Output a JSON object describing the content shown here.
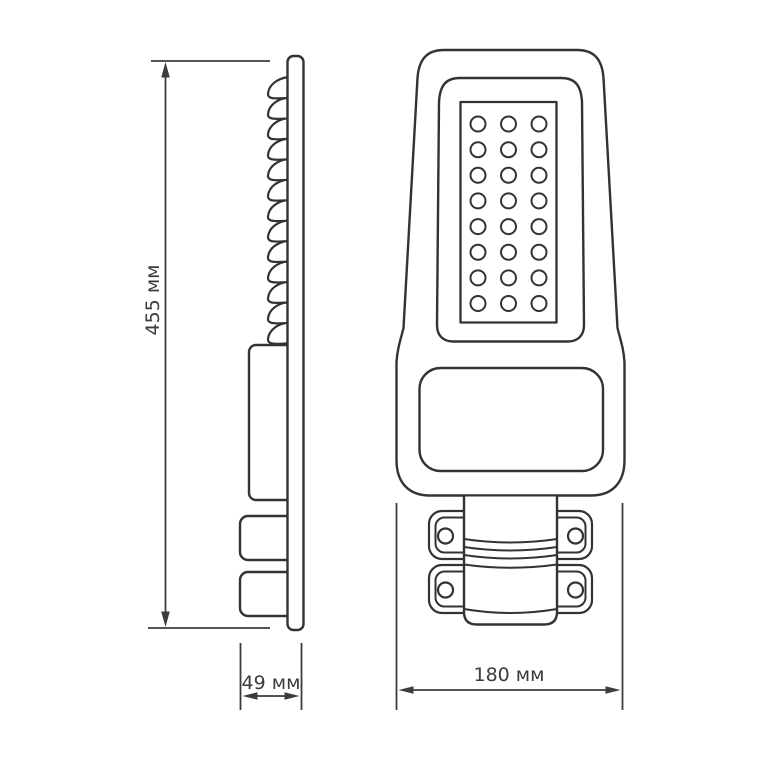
{
  "page": {
    "background": "#ffffff",
    "line_color": "#333333",
    "text_color": "#3c3c3c"
  },
  "drawing": {
    "type": "street-light-dimension-diagram",
    "dimensions": {
      "height": {
        "label": "455 мм"
      },
      "depth": {
        "label": "49 мм"
      },
      "width": {
        "label": "180 мм"
      }
    },
    "side_view": {
      "fin_count": 13,
      "fin_top_y": 77,
      "fin_spacing": 20.45
    },
    "front_view": {
      "led_grid": {
        "rows": 8,
        "cols": 3,
        "count": 24,
        "cx0": 478,
        "dx": 30.5,
        "cy0": 124,
        "dy": 25.65,
        "r": 7.5
      },
      "clamp_count": 2
    }
  }
}
